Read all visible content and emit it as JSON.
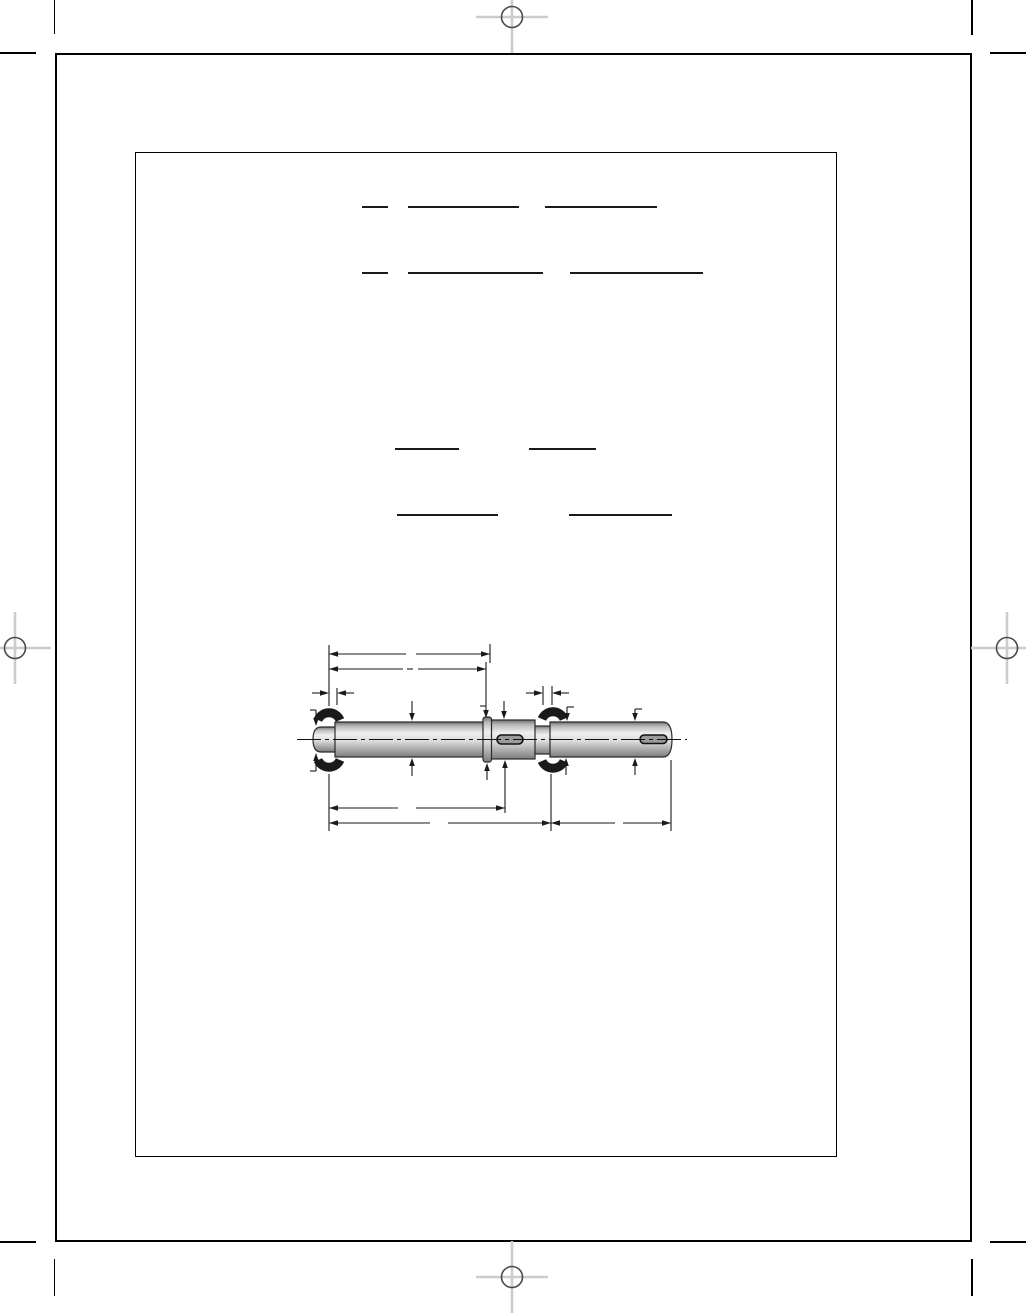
{
  "document": {
    "kind": "blank engineering worksheet page",
    "visible_text": "",
    "notes": "page contains no rendered text; only frames, blank rule lines, printer marks and a dimensioned shaft drawing with empty dimension values"
  },
  "colors": {
    "paper": "#ffffff",
    "ink": "#1a1a1a",
    "frame_border": "#000000",
    "registration_cross": "#cccccc",
    "registration_circle": "#4a4a4a",
    "shaft_highlight": "#efefef",
    "shaft_shadow": "#8a8a8a",
    "bearing_fill": "#1a1a1a",
    "keyway_fill": "#9a9a9a"
  },
  "icons": {
    "registration_mark": "crosshair-circle-icon",
    "crop_mark": "corner-trim-line"
  },
  "registration_marks": [
    {
      "cx": 512,
      "cy": 17,
      "position": "top-center"
    },
    {
      "cx": 15,
      "cy": 648,
      "position": "left-middle"
    },
    {
      "cx": 1007,
      "cy": 648,
      "position": "right-middle"
    },
    {
      "cx": 512,
      "cy": 1277,
      "position": "bottom-center"
    }
  ],
  "blank_lines": [
    {
      "y": 206,
      "segments": [
        [
          362,
          388
        ],
        [
          408,
          519
        ],
        [
          545,
          657
        ]
      ]
    },
    {
      "y": 272,
      "segments": [
        [
          362,
          388
        ],
        [
          408,
          543
        ],
        [
          570,
          703
        ]
      ]
    },
    {
      "y": 448,
      "segments": [
        [
          395,
          459
        ],
        [
          529,
          596
        ]
      ]
    },
    {
      "y": 514,
      "segments": [
        [
          397,
          498
        ],
        [
          569,
          672
        ]
      ]
    }
  ],
  "figure": {
    "type": "technical-drawing",
    "subject": "stepped shaft, side view",
    "parts": [
      "left-stub-end",
      "left-bearing",
      "main-body",
      "collar",
      "keyway-section",
      "keyway-slot-mid",
      "neck",
      "right-bearing",
      "right-extension",
      "keyway-slot-end"
    ],
    "dimension_values": []
  }
}
